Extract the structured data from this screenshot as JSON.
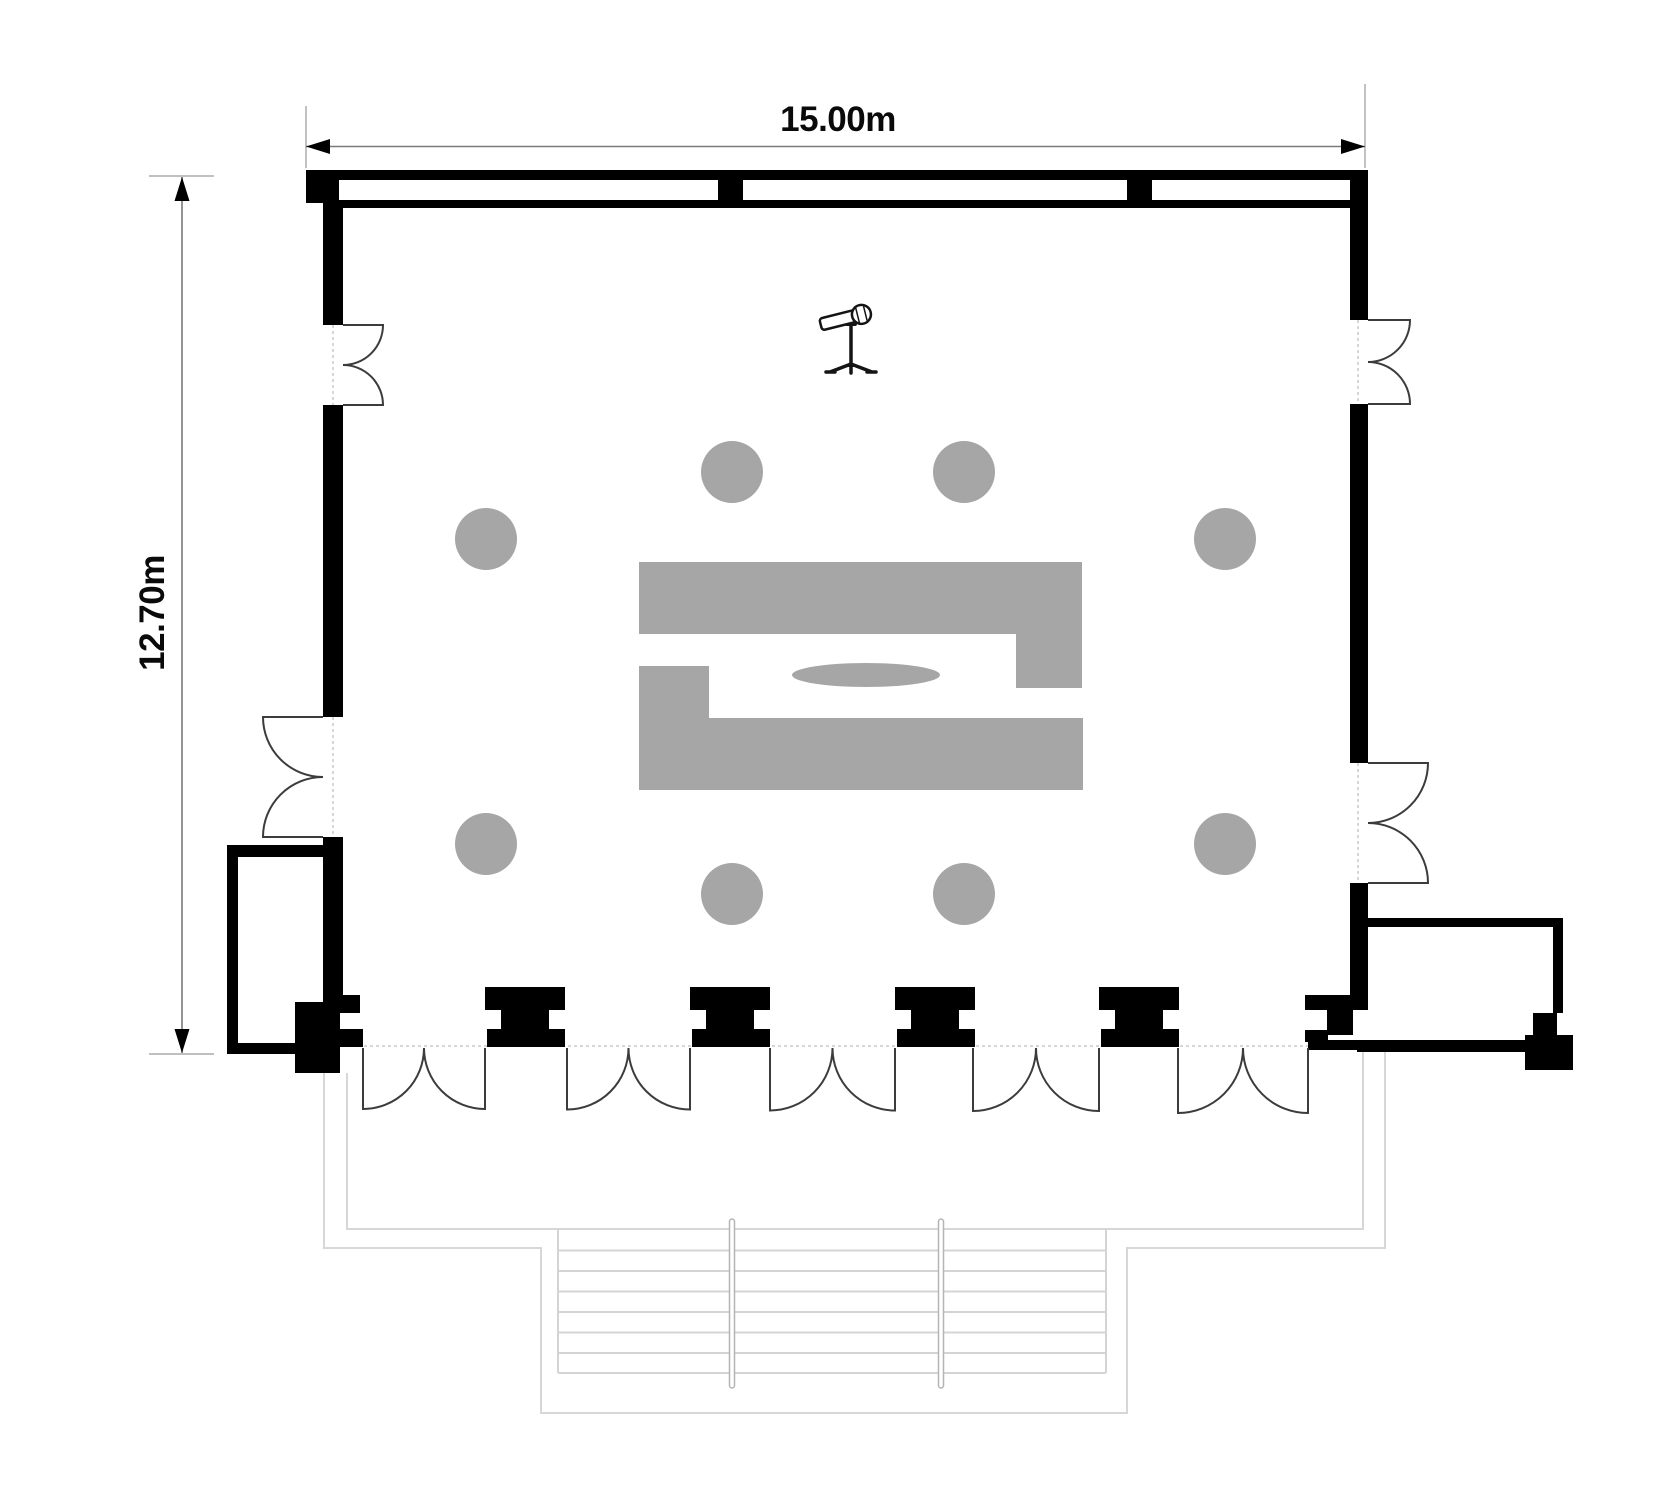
{
  "plan": {
    "type": "room-floor-plan",
    "dimensions": {
      "horizontal": {
        "label": "15.00m"
      },
      "vertical": {
        "label": "12.70m"
      }
    },
    "counts": {
      "chairs": 8,
      "bottom_entrance_doors": 5,
      "bottom_columns": 4,
      "side_double_doors": 4,
      "window_mullions": 2
    },
    "icons": {
      "microphone": "microphone-stand-icon"
    },
    "colors": {
      "wall": "#000000",
      "furniture": "#a6a6a6",
      "dimension_line": "#7a7a7a",
      "dimension_text": "#0a0a0a",
      "door_swing": "#3c3c3c",
      "threshold": "#c8c8c8",
      "terrace_line": "#d7d7d7",
      "background": "#ffffff"
    }
  }
}
